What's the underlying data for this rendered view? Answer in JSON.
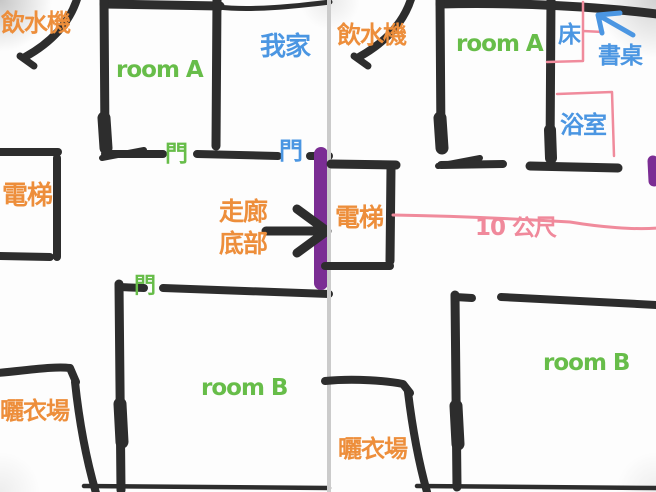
{
  "colors": {
    "wall_black": "#2d2d2d",
    "label_orange": "#ed8e3b",
    "label_green": "#67bd49",
    "label_blue": "#4b96e2",
    "sketch_pink": "#f08b9c",
    "door_purple": "#7b2d94",
    "panel_divider": "#cbcbcb"
  },
  "icons": {
    "corridor_arrow": "black-arrow-right",
    "desk_arrow": "blue-arrow-up-left"
  },
  "left_panel": {
    "water_dispenser": "飲水機",
    "room_a": "room A",
    "my_home": "我家",
    "door_room_a": "門",
    "door_corridor_end": "門",
    "elevator": "電梯",
    "corridor_end_line1": "走廊",
    "corridor_end_line2": "底部",
    "door_room_b": "門",
    "room_b": "room B",
    "drying_area": "曬衣場"
  },
  "right_panel": {
    "water_dispenser": "飲水機",
    "room_a": "room A",
    "bed": "床",
    "desk": "書桌",
    "bathroom": "浴室",
    "elevator": "電梯",
    "distance": "10 公尺",
    "room_b": "room B",
    "drying_area": "曬衣場"
  }
}
